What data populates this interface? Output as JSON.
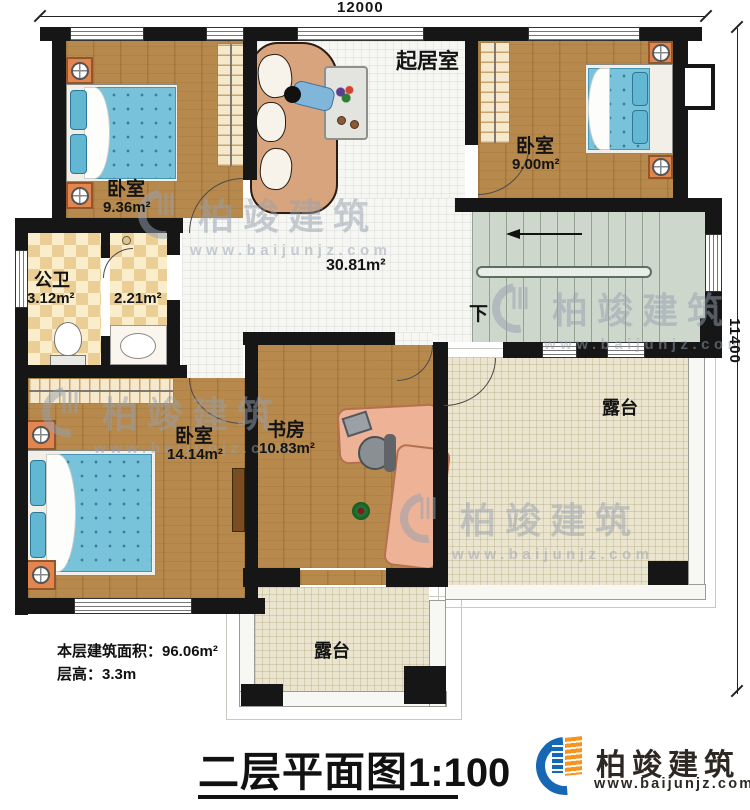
{
  "dimensions": {
    "width_top": "12000",
    "height_right": "11400"
  },
  "rooms": {
    "living": {
      "name": "起居室",
      "area": "30.81m²"
    },
    "bedroom_tl": {
      "name": "卧室",
      "area": "9.36m²"
    },
    "bedroom_tr": {
      "name": "卧室",
      "area": "9.00m²"
    },
    "bath": {
      "name": "公卫",
      "area": "3.12m²"
    },
    "vanity": {
      "area": "2.21m²"
    },
    "bedroom_bl": {
      "name": "卧室",
      "area": "14.14m²"
    },
    "study": {
      "name": "书房",
      "area": "10.83m²"
    },
    "terrace_right": {
      "name": "露台"
    },
    "terrace_bottom": {
      "name": "露台"
    }
  },
  "stairs": {
    "direction_label": "下"
  },
  "annotations": {
    "floor_area": "本层建筑面积：96.06m²",
    "floor_height": "层高：3.3m"
  },
  "title": {
    "name": "二层平面图",
    "scale": "1:100"
  },
  "brand": {
    "name": "柏竣建筑",
    "website": "www.baijunjz.com"
  },
  "watermark": {
    "name": "柏竣建筑",
    "website": "www.baijunjz.com"
  },
  "colors": {
    "wall": "#161616",
    "wood_floor": "#b7894c",
    "mattress_blue": "#79c3da",
    "terrace_beige": "#ebe5cf",
    "stairs_green": "#cdd7cc",
    "bath_checker": "#ebcd96",
    "brand_blue": "#1668b5",
    "brand_orange": "#f7941d"
  }
}
